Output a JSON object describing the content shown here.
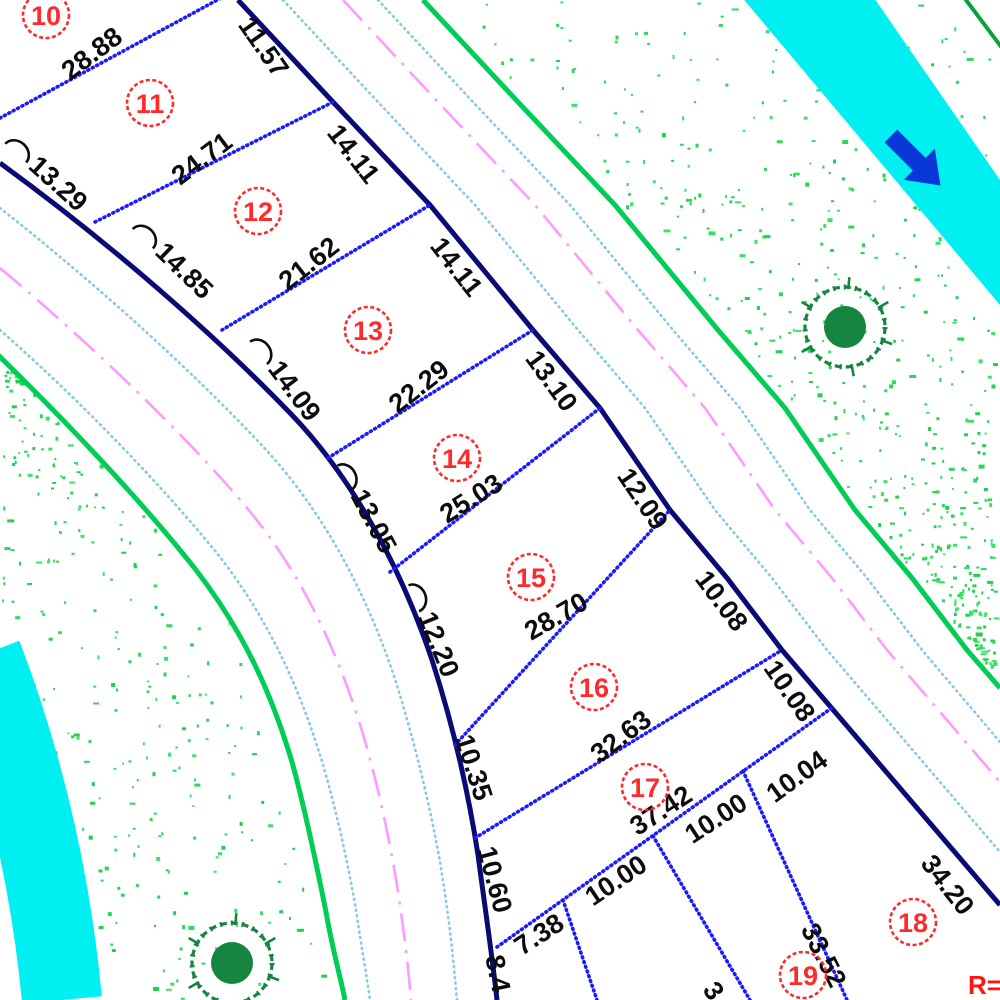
{
  "plan": {
    "type": "cadastral-subdivision-plan",
    "palette": {
      "lot_boundary_navy": "#0a0a74",
      "lot_line_blue": "#1a1aff",
      "lot_number_red": "#ff2a2a",
      "dimension_text": "#0c0c0c",
      "road_edge_green": "#00cd55",
      "sidewalk_cyan": "#85c9e6",
      "centerline_magenta": "#ff9aff",
      "water_cyan": "#00f0f2",
      "flow_arrow_blue": "#0a38d8",
      "vegetation_dot_green": "#2bd95a",
      "tree_green": "#158540"
    },
    "water_channel": {
      "flow_arrow_direction": "southeast"
    },
    "tree_symbols": [
      {
        "cx": 845,
        "cy": 327
      },
      {
        "cx": 232,
        "cy": 963
      }
    ],
    "annotation": {
      "text": "R=2",
      "x": 968,
      "y": 994
    }
  },
  "lots": [
    {
      "number": "10",
      "cx": 46,
      "cy": 15
    },
    {
      "number": "11",
      "cx": 150,
      "cy": 103
    },
    {
      "number": "12",
      "cx": 258,
      "cy": 211
    },
    {
      "number": "13",
      "cx": 368,
      "cy": 330
    },
    {
      "number": "14",
      "cx": 457,
      "cy": 458
    },
    {
      "number": "15",
      "cx": 531,
      "cy": 577
    },
    {
      "number": "16",
      "cx": 594,
      "cy": 687
    },
    {
      "number": "17",
      "cx": 645,
      "cy": 787
    },
    {
      "number": "18",
      "cx": 913,
      "cy": 922
    },
    {
      "number": "19",
      "cx": 803,
      "cy": 975
    }
  ],
  "dimensions": [
    {
      "text": "28.88",
      "x": 93,
      "y": 55,
      "rot": -37,
      "arc": false
    },
    {
      "text": "24.71",
      "x": 203,
      "y": 160,
      "rot": -37,
      "arc": false
    },
    {
      "text": "21.62",
      "x": 310,
      "y": 265,
      "rot": -38,
      "arc": false
    },
    {
      "text": "22.29",
      "x": 420,
      "y": 388,
      "rot": -38,
      "arc": false
    },
    {
      "text": "25.03",
      "x": 472,
      "y": 500,
      "rot": -32,
      "arc": false
    },
    {
      "text": "28.70",
      "x": 557,
      "y": 618,
      "rot": -30,
      "arc": false
    },
    {
      "text": "32.63",
      "x": 622,
      "y": 738,
      "rot": -37,
      "arc": false
    },
    {
      "text": "37.42",
      "x": 662,
      "y": 812,
      "rot": -33,
      "arc": false
    },
    {
      "text": "7.38",
      "x": 540,
      "y": 936,
      "rot": -33,
      "arc": false
    },
    {
      "text": "10.00",
      "x": 617,
      "y": 882,
      "rot": -34,
      "arc": false
    },
    {
      "text": "10.00",
      "x": 717,
      "y": 820,
      "rot": -33,
      "arc": false
    },
    {
      "text": "10.04",
      "x": 798,
      "y": 778,
      "rot": -36,
      "arc": false
    },
    {
      "text": "11.57",
      "x": 262,
      "y": 48,
      "rot": 55,
      "arc": false
    },
    {
      "text": "14.11",
      "x": 352,
      "y": 155,
      "rot": 52,
      "arc": false
    },
    {
      "text": "14.11",
      "x": 455,
      "y": 268,
      "rot": 52,
      "arc": false
    },
    {
      "text": "13.10",
      "x": 550,
      "y": 382,
      "rot": 54,
      "arc": false
    },
    {
      "text": "12.09",
      "x": 641,
      "y": 500,
      "rot": 56,
      "arc": false
    },
    {
      "text": "10.08",
      "x": 720,
      "y": 602,
      "rot": 53,
      "arc": false
    },
    {
      "text": "10.08",
      "x": 788,
      "y": 692,
      "rot": 55,
      "arc": false
    },
    {
      "text": "34.20",
      "x": 946,
      "y": 886,
      "rot": 52,
      "arc": false
    },
    {
      "text": "33.52",
      "x": 822,
      "y": 956,
      "rot": 63,
      "arc": false
    },
    {
      "text": "3",
      "x": 712,
      "y": 992,
      "rot": 55,
      "arc": false
    },
    {
      "text": "13.29",
      "x": 57,
      "y": 185,
      "rot": 42,
      "arc": true
    },
    {
      "text": "14.85",
      "x": 183,
      "y": 272,
      "rot": 44,
      "arc": true
    },
    {
      "text": "14.09",
      "x": 293,
      "y": 392,
      "rot": 53,
      "arc": true
    },
    {
      "text": "13.05",
      "x": 372,
      "y": 522,
      "rot": 62,
      "arc": true
    },
    {
      "text": "12.20",
      "x": 437,
      "y": 645,
      "rot": 68,
      "arc": true
    },
    {
      "text": "10.35",
      "x": 472,
      "y": 768,
      "rot": 72,
      "arc": false
    },
    {
      "text": "10.60",
      "x": 493,
      "y": 880,
      "rot": 75,
      "arc": false
    },
    {
      "text": "8.4",
      "x": 496,
      "y": 974,
      "rot": 78,
      "arc": false
    }
  ]
}
